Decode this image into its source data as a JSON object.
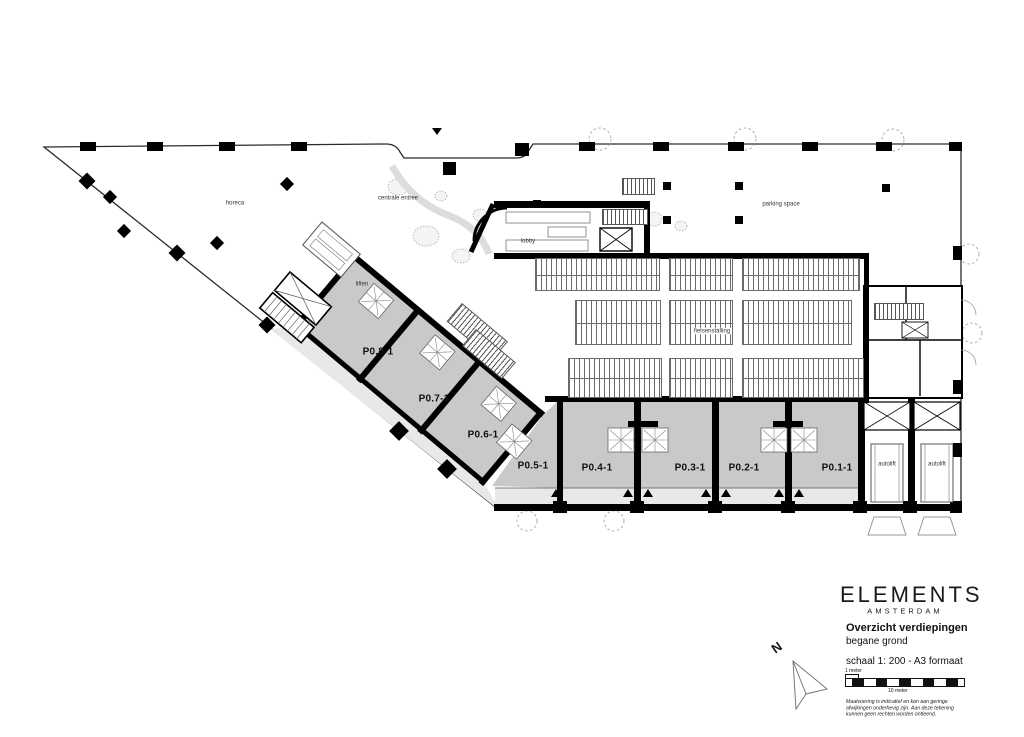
{
  "title_block": {
    "brand": "ELEMENTS",
    "brand_subtitle": "AMSTERDAM",
    "drawing_title": "Overzicht verdiepingen",
    "drawing_subtitle": "begane grond",
    "scale_note": "schaal 1: 200 - A3 formaat",
    "scale_bar": {
      "small_label": "1 meter",
      "large_label": "10 meter"
    },
    "disclaimer_lines": [
      "Maatvoering is indicatief en kan aan geringe",
      "afwijkingen onderhevig zijn. Aan deze tekening",
      "kunnen geen rechten worden ontleend."
    ],
    "north_label": "N"
  },
  "plan": {
    "rooms": [
      {
        "id": "horeca",
        "label": "horeca"
      },
      {
        "id": "centrale-entree",
        "label": "centrale entree"
      },
      {
        "id": "lobby",
        "label": "lobby"
      },
      {
        "id": "liften",
        "label": "liften"
      },
      {
        "id": "parking-space",
        "label": "parking space"
      },
      {
        "id": "fietsenstalling",
        "label": "fietsenstalling"
      },
      {
        "id": "autolift-1",
        "label": "autolift"
      },
      {
        "id": "autolift-2",
        "label": "autolift"
      }
    ],
    "units": [
      {
        "id": "P0.8-1",
        "label": "P0.8-1"
      },
      {
        "id": "P0.7-1",
        "label": "P0.7-1"
      },
      {
        "id": "P0.6-1",
        "label": "P0.6-1"
      },
      {
        "id": "P0.5-1",
        "label": "P0.5-1"
      },
      {
        "id": "P0.4-1",
        "label": "P0.4-1"
      },
      {
        "id": "P0.3-1",
        "label": "P0.3-1"
      },
      {
        "id": "P0.2-1",
        "label": "P0.2-1"
      },
      {
        "id": "P0.1-1",
        "label": "P0.1-1"
      }
    ],
    "colors": {
      "unit_fill": "#c9c9c9",
      "walkway_fill": "#e8e8e8",
      "wall": "#000000"
    }
  }
}
